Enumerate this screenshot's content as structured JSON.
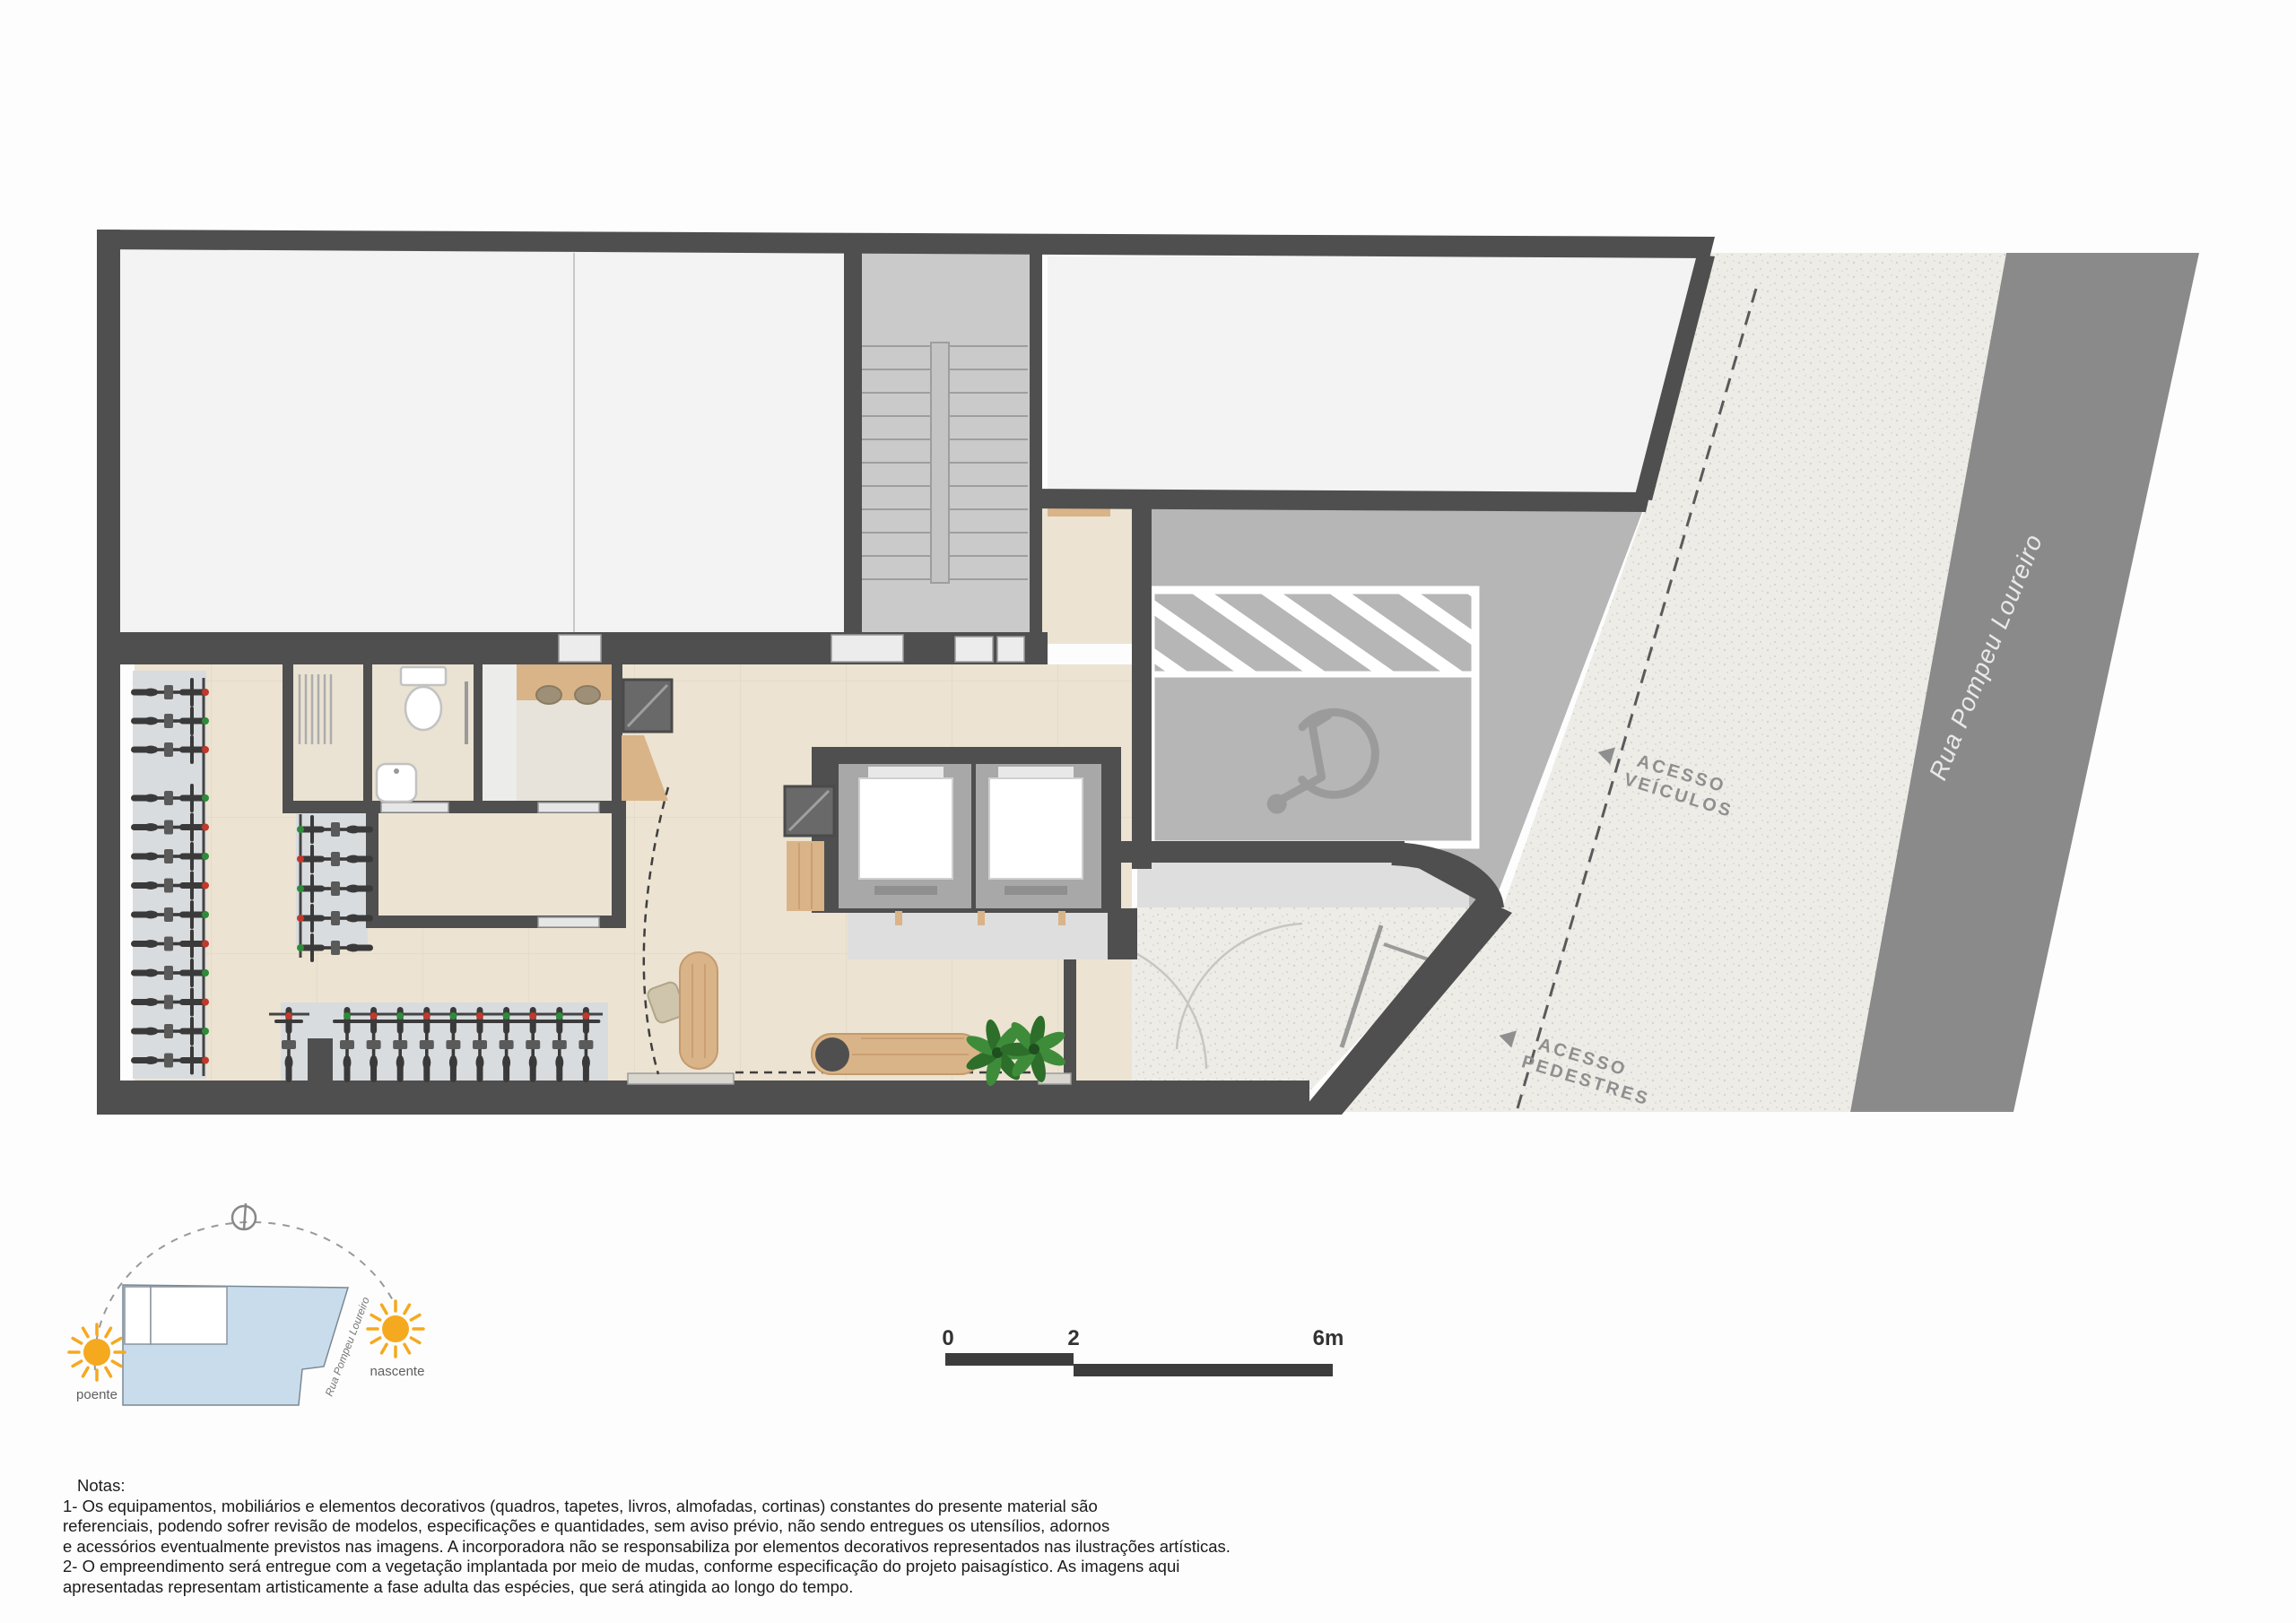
{
  "plan": {
    "street_name": "Rua Pompeu Loureiro",
    "access_vehicles": {
      "line1": "ACESSO",
      "line2": "VEÍCULOS"
    },
    "access_pedestrians": {
      "line1": "ACESSO",
      "line2": "PEDESTRES"
    },
    "scale_bar": {
      "tick0": "0",
      "tick1": "2",
      "tick2": "6m"
    },
    "inset": {
      "west": "poente",
      "east": "nascente",
      "street": "Rua Pompeu Loureiro"
    },
    "bike_counts": {
      "left_rack": 13,
      "middle_rack": 5,
      "bottom_rack": 11
    },
    "colors": {
      "wall": "#4f4f4f",
      "floor_white": "#f3f3f3",
      "floor_beige": "#ece3d2",
      "concrete": "#b6b6b6",
      "sidewalk": "#edece7",
      "road": "#8a8a8a",
      "corridor": "#dedede",
      "rack_strip": "#d9dcdf",
      "wood": "#d9b488",
      "bike": "#3a3a3a",
      "sun": "#f5a91f",
      "site_blue": "#c9dcec",
      "street_text": "#e9e9e9",
      "access_text": "#8f8f8f",
      "accent_red": "#c0392b",
      "accent_green": "#2e8b3a",
      "plant_green": "#3e8c3a"
    }
  },
  "notes": {
    "title": "Notas:",
    "lines": [
      "1- Os equipamentos, mobiliários e elementos decorativos (quadros, tapetes, livros, almofadas, cortinas) constantes do presente material são",
      "referenciais, podendo sofrer revisão de modelos, especificações e quantidades, sem aviso prévio, não sendo entregues os utensílios, adornos",
      "e acessórios eventualmente previstos nas imagens. A incorporadora não se responsabiliza por elementos decorativos representados nas ilustrações artísticas.",
      "2- O empreendimento será entregue com a vegetação implantada por meio de mudas, conforme especificação do projeto paisagístico. As imagens aqui",
      "apresentadas representam artisticamente a fase adulta das espécies, que será atingida ao longo do tempo."
    ]
  }
}
